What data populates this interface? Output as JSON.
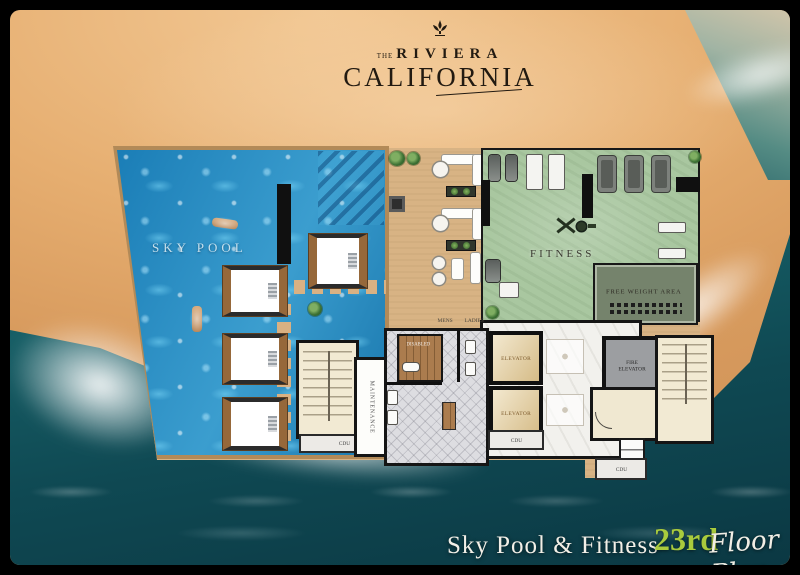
{
  "brand": {
    "the": "THE",
    "riviera": "RIVIERA",
    "california": "CALIFORNIA"
  },
  "rooms": {
    "sky_pool": "SKY POOL",
    "fitness": "FITNESS",
    "free_weight": "FREE WEIGHT AREA",
    "elevator_upper": "ELEVATOR",
    "elevator_lower": "ELEVATOR",
    "fire_elevator": "FIRE ELEVATOR",
    "maintenance": "MAINTENANCE",
    "mens": "MENS",
    "ladies": "LADIES",
    "disabled": "DISABLED",
    "cdu_left": "CDU",
    "cdu_center": "CDU",
    "cdu_right": "CDU"
  },
  "caption": {
    "title": "Sky Pool & Fitness",
    "floor_number": "23rd",
    "floor_label": "Floor Plan"
  },
  "colors": {
    "pool_water": "#2090c8",
    "fitness_floor": "#a9c7a0",
    "free_weight_floor": "#75836c",
    "sand": "#e6ae70",
    "ocean": "#0f4953",
    "deck": "#d8b384",
    "accent_green": "#a9cb3d",
    "frame": "#000000"
  }
}
